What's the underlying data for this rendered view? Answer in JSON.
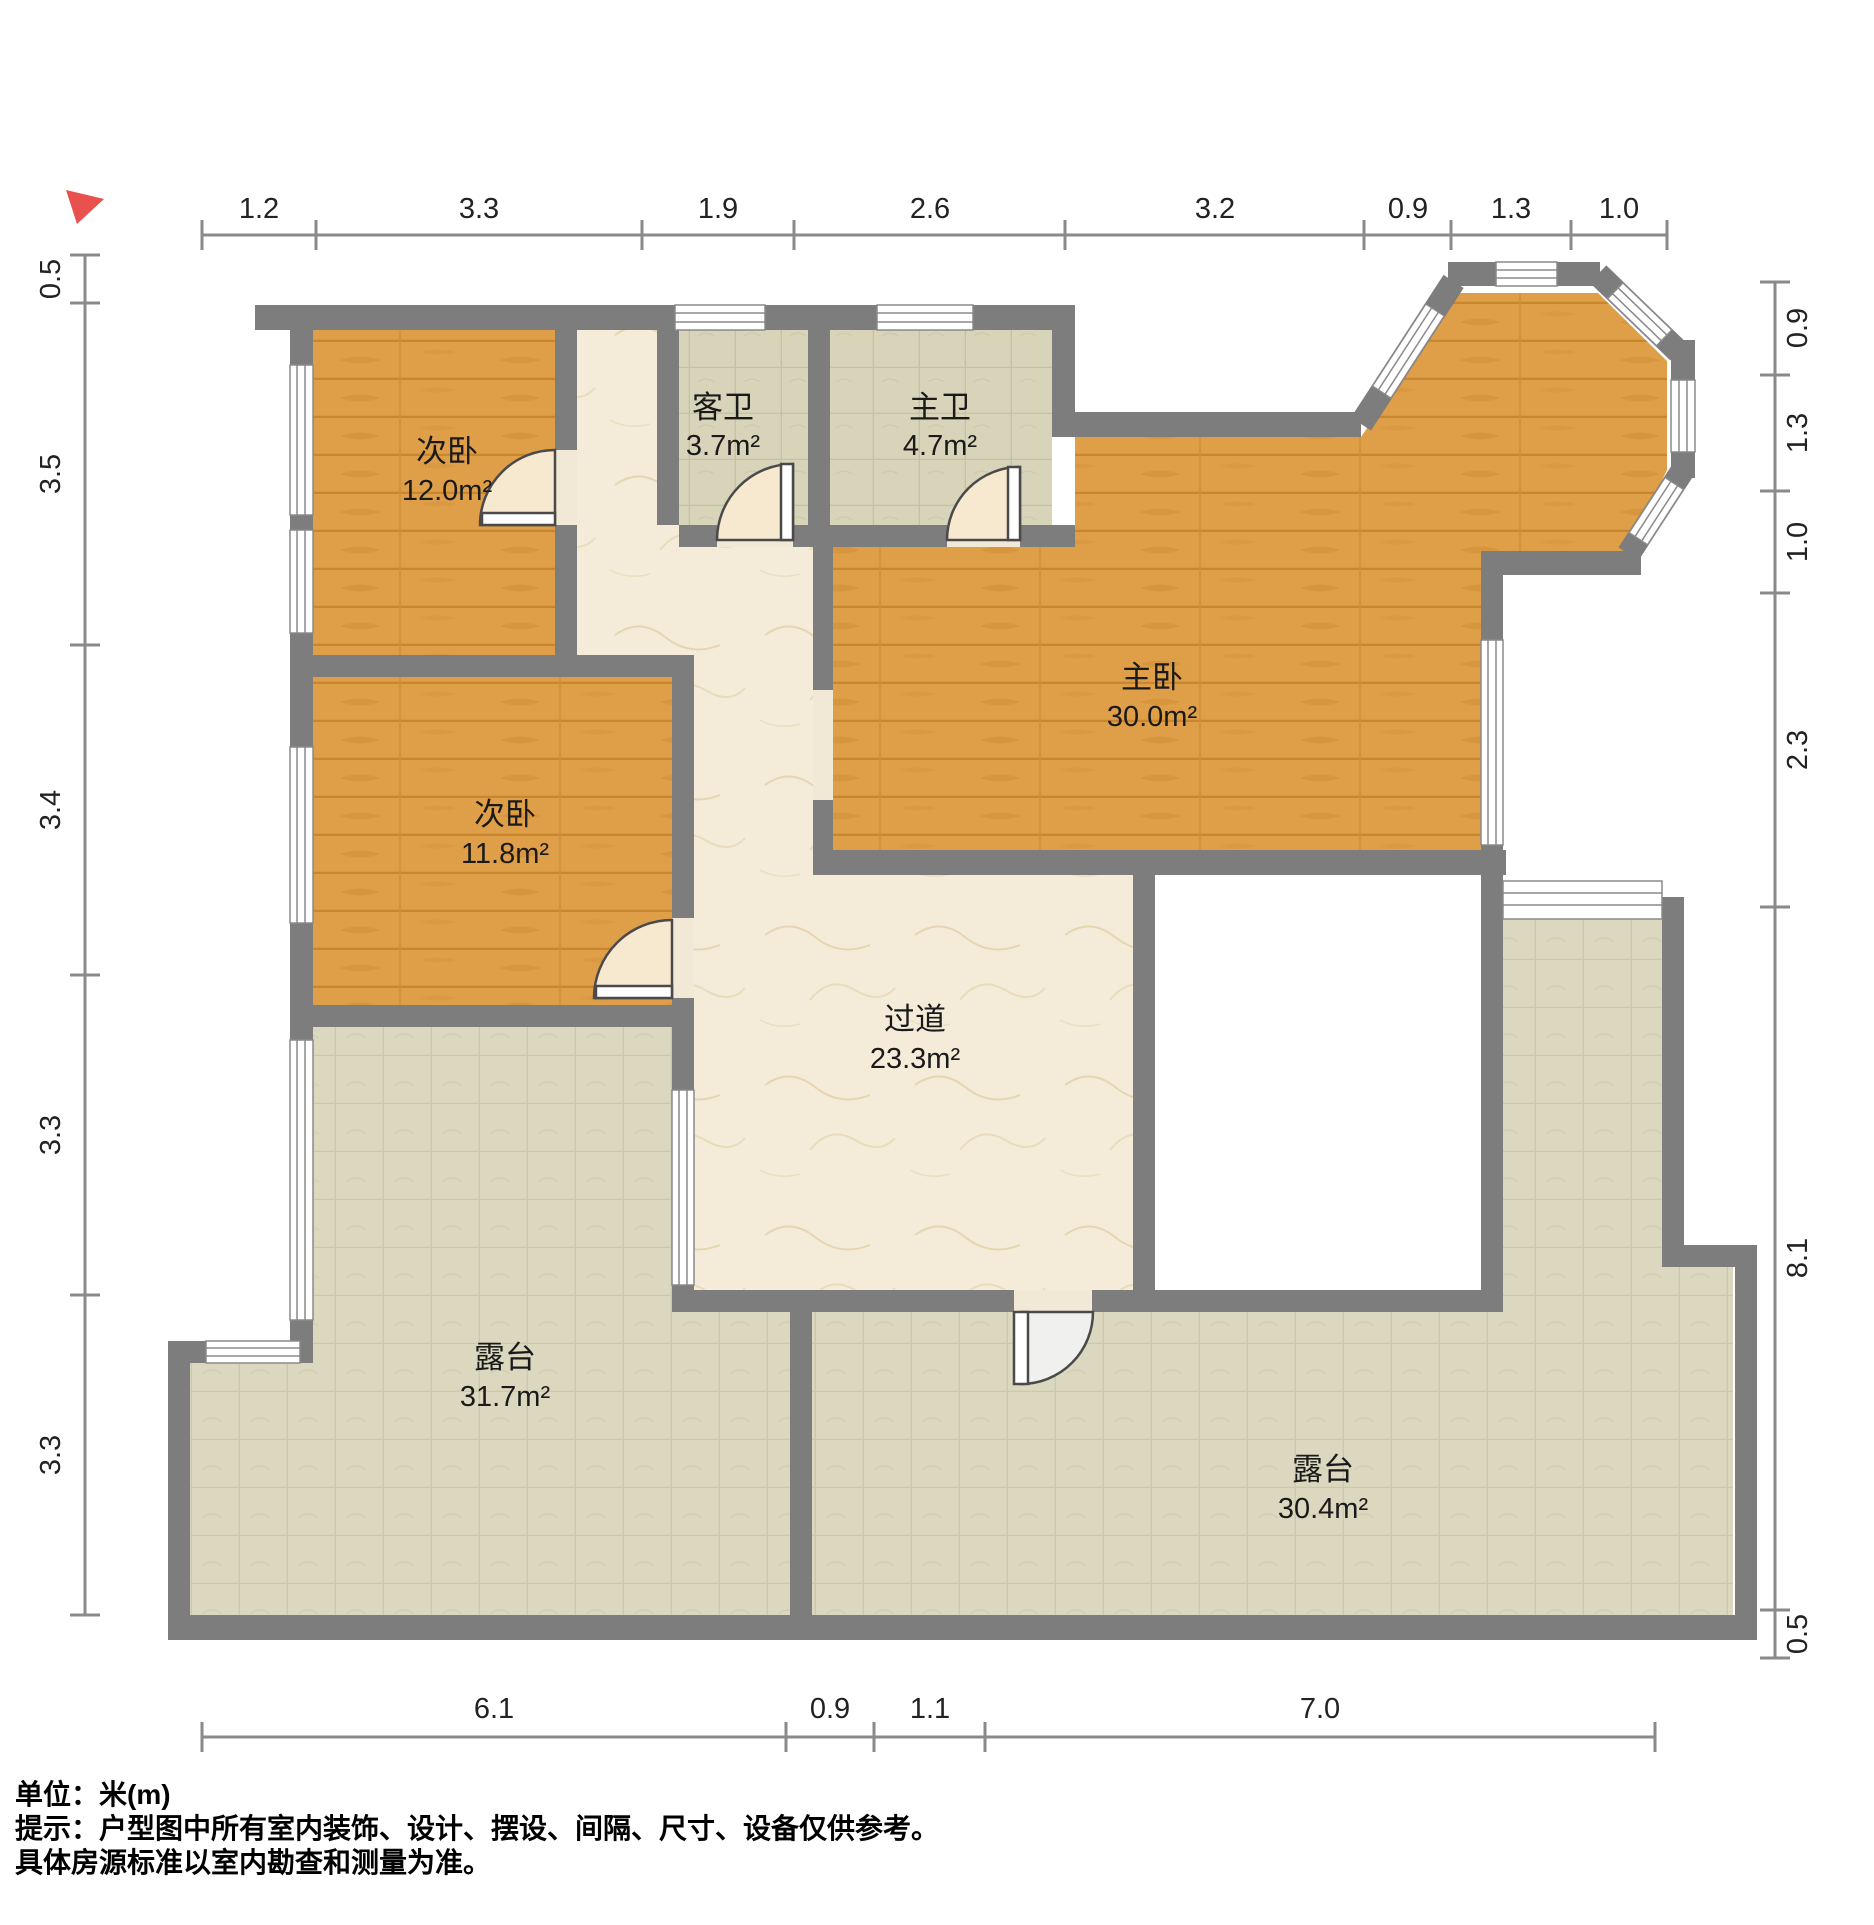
{
  "plan_title": "户型图",
  "unit_note": "米(m)",
  "rooms": [
    {
      "id": "bedroom-secondary-1",
      "name": "次卧",
      "area": "12.0m²"
    },
    {
      "id": "bedroom-secondary-2",
      "name": "次卧",
      "area": "11.8m²"
    },
    {
      "id": "guest-bath",
      "name": "客卫",
      "area": "3.7m²"
    },
    {
      "id": "master-bath",
      "name": "主卫",
      "area": "4.7m²"
    },
    {
      "id": "master-bedroom",
      "name": "主卧",
      "area": "30.0m²"
    },
    {
      "id": "corridor",
      "name": "过道",
      "area": "23.3m²"
    },
    {
      "id": "terrace-left",
      "name": "露台",
      "area": "31.7m²"
    },
    {
      "id": "terrace-right",
      "name": "露台",
      "area": "30.4m²"
    }
  ],
  "dimensions": {
    "top": [
      "1.2",
      "3.3",
      "1.9",
      "2.6",
      "3.2",
      "0.9",
      "1.3",
      "1.0"
    ],
    "left": [
      "0.5",
      "3.5",
      "3.4",
      "3.3",
      "3.3"
    ],
    "right": [
      "0.9",
      "1.3",
      "1.0",
      "2.3",
      "8.1",
      "0.5"
    ],
    "bottom": [
      "6.1",
      "0.9",
      "1.1",
      "7.0"
    ]
  },
  "footer": {
    "line1": "单位：米(m)",
    "line2": "提示：户型图中所有室内装饰、设计、摆设、间隔、尺寸、设备仅供参考。",
    "line3": "具体房源标准以室内勘查和测量为准。"
  },
  "colors": {
    "wall": "#7d7d7d",
    "wood_floor": "#df9e48",
    "bath_tile": "#d8d4ba",
    "terrace_tile": "#dbd8bf",
    "marble": "#f4ecd9",
    "door_leaf": "#f7e8d0",
    "north_arrow": "#e8514e",
    "dim_line": "#8a8a8a"
  }
}
